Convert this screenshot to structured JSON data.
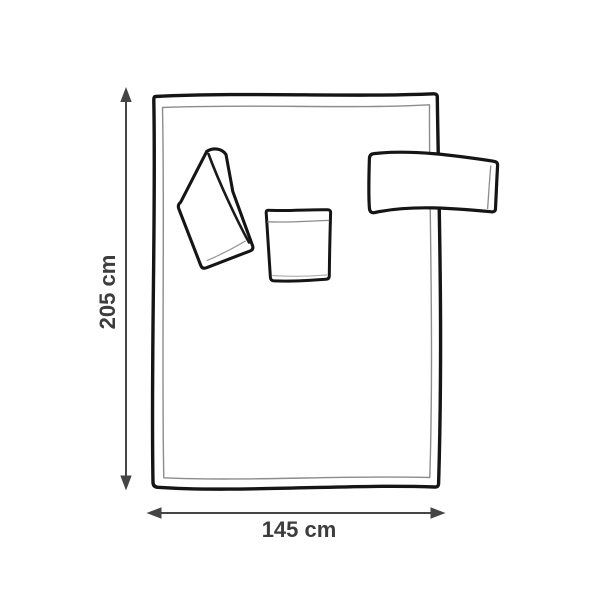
{
  "diagram": {
    "type": "product-dimensions-diagram",
    "shapes": [
      "blanket-outline",
      "folded-flap",
      "center-pocket",
      "side-sleeve",
      "height-arrow",
      "width-arrow"
    ],
    "dimensions": {
      "height": {
        "label": "205 cm",
        "value": 205,
        "unit": "cm"
      },
      "width": {
        "label": "145 cm",
        "value": 145,
        "unit": "cm"
      }
    },
    "colors": {
      "background": "#ffffff",
      "outline": "#151515",
      "seam": "#8c8c8c",
      "dimension_arrow": "#454545",
      "label_text": "#3d3d3d"
    }
  }
}
